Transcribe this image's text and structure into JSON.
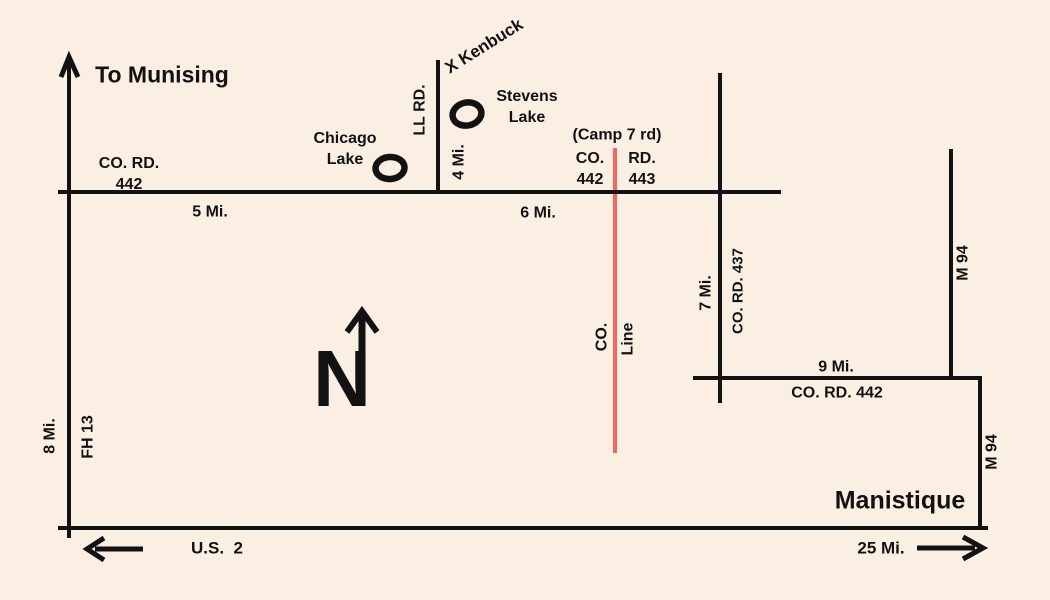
{
  "labels": {
    "to_munising": "To Munising",
    "co_rd_442_west": [
      "CO. RD.",
      "442"
    ],
    "five_mi": "5 Mi.",
    "chicago_lake": [
      "Chicago",
      "Lake"
    ],
    "ll_rd": "LL RD.",
    "x_kenbuck": "X Kenbuck",
    "four_mi": "4 Mi.",
    "stevens_lake": [
      "Stevens",
      "Lake"
    ],
    "camp_7_rd": "(Camp 7 rd)",
    "co_442": [
      "CO.",
      "442"
    ],
    "rd_443": [
      "RD.",
      "443"
    ],
    "six_mi": "6 Mi.",
    "county_line": [
      "CO.",
      "Line"
    ],
    "seven_mi": "7 Mi.",
    "co_rd_437": "CO. RD. 437",
    "m94_north": "M 94",
    "nine_mi": "9 Mi.",
    "co_rd_442_east": "CO. RD. 442",
    "m94_south": "M 94",
    "manistique": "Manistique",
    "eight_mi": "8 Mi.",
    "fh_13": "FH 13",
    "us_2": "U.S.  2",
    "twenty_five_mi": "25 Mi.",
    "compass_n": "N"
  },
  "colors": {
    "background": "#fbeee3",
    "road": "#121212",
    "county_line": "#f7645f",
    "text": "#121212"
  }
}
